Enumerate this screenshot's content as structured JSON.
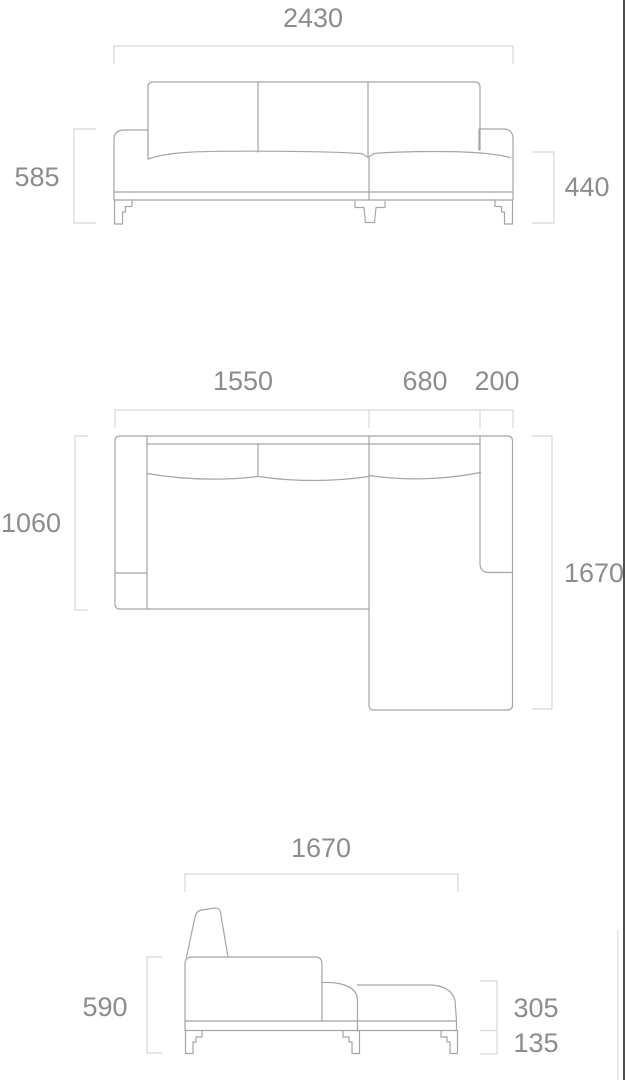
{
  "colors": {
    "background": "#ffffff",
    "outline": "#a5a5a5",
    "dim_line": "#d8d8d8",
    "dim_text": "#8c8c8c",
    "window_border": "#4f4f4f",
    "scrollbar": "#e6e6e6"
  },
  "diagram_title": "Sectional sofa dimension drawing (three orthographic views)",
  "views": {
    "front": {
      "label": "front-elevation",
      "dims": {
        "overall_width": "2430",
        "arm_height_left": "585",
        "seat_height_right": "440"
      }
    },
    "plan": {
      "label": "top-plan-view",
      "dims": {
        "seat_section_width": "1550",
        "chaise_width": "680",
        "arm_width": "200",
        "depth_left": "1060",
        "chaise_length_right": "1670"
      }
    },
    "side": {
      "label": "side-elevation",
      "dims": {
        "overall_depth": "1670",
        "back_height_left": "590",
        "seat_height_right": "305",
        "leg_height_right": "135"
      }
    }
  }
}
